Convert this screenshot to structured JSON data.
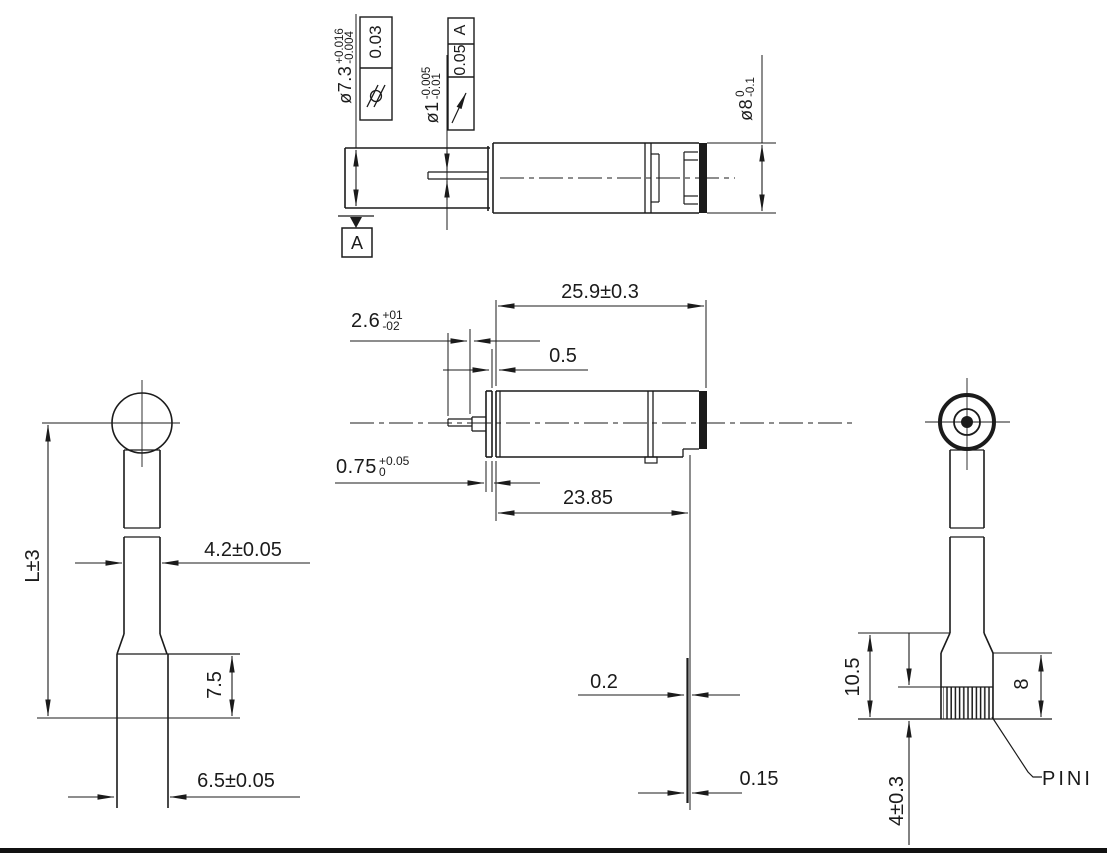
{
  "drawing_title": "motor-pin-dimension-drawing",
  "views": {
    "top": {
      "dia_collar": {
        "value": "ø7.3",
        "tol_upper": "+0.016",
        "tol_lower": "-0.004"
      },
      "fcf_collar": {
        "symbol": "cylindricity",
        "tolerance": "0.03"
      },
      "dia_shaft": {
        "value": "ø1",
        "tol_upper": "-0.005",
        "tol_lower": "-0.01"
      },
      "fcf_shaft": {
        "symbol": "circular-runout",
        "tolerance": "0.05",
        "datum_ref": "A"
      },
      "dia_body": {
        "value": "ø8",
        "tol_upper": "0",
        "tol_lower": "-0.1"
      },
      "datum_label": "A"
    },
    "front": {
      "total_length": "25.9±0.3",
      "shaft_length": {
        "value": "2.6",
        "tol_upper": "+01",
        "tol_lower": "-02"
      },
      "step": "0.5",
      "flange_thickness": {
        "value": "0.75",
        "tol_upper": "+0.05",
        "tol_lower": "0"
      },
      "body_length": "23.85",
      "runout_a": "0.2",
      "runout_b": "0.15"
    },
    "left": {
      "overall_length": "L±3",
      "shaft_width": "4.2±0.05",
      "cap_height": "7.5",
      "base_width": "6.5±0.05"
    },
    "right": {
      "cap_height": "10.5",
      "terminal_height": "8",
      "pin_length": "4±0.3",
      "pin_label": "PINI"
    }
  }
}
